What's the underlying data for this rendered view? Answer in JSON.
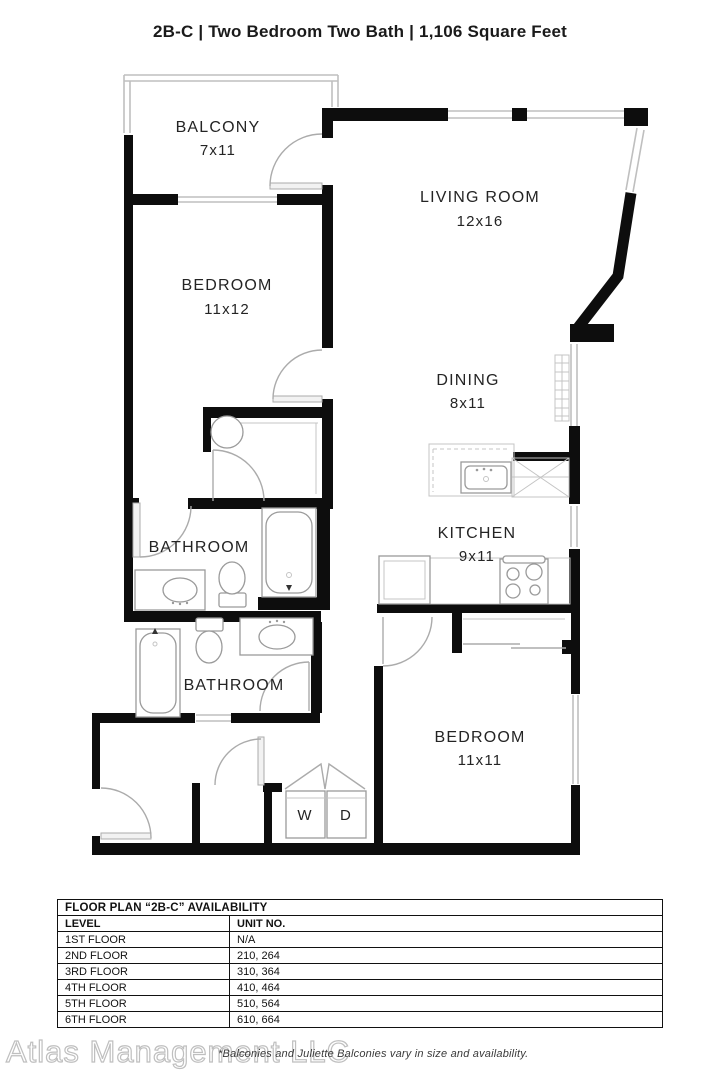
{
  "title": "2B-C | Two Bedroom Two Bath | 1,106 Square Feet",
  "floor_plan": {
    "balcony": {
      "label": "BALCONY",
      "dims": "7x11"
    },
    "living": {
      "label": "LIVING ROOM",
      "dims": "12x16"
    },
    "bedroom1": {
      "label": "BEDROOM",
      "dims": "11x12"
    },
    "dining": {
      "label": "DINING",
      "dims": "8x11"
    },
    "kitchen": {
      "label": "KITCHEN",
      "dims": "9x11"
    },
    "bathroom1": {
      "label": "BATHROOM"
    },
    "bathroom2": {
      "label": "BATHROOM"
    },
    "bedroom2": {
      "label": "BEDROOM",
      "dims": "11x11"
    },
    "washer_label": "W",
    "dryer_label": "D"
  },
  "availability_table": {
    "title": "FLOOR PLAN “2B-C” AVAILABILITY",
    "columns": [
      "LEVEL",
      "UNIT NO."
    ],
    "rows": [
      [
        "1ST FLOOR",
        "N/A"
      ],
      [
        "2ND FLOOR",
        "210, 264"
      ],
      [
        "3RD FLOOR",
        "310, 364"
      ],
      [
        "4TH FLOOR",
        "410, 464"
      ],
      [
        "5TH FLOOR",
        "510, 564"
      ],
      [
        "6TH FLOOR",
        "610, 664"
      ]
    ]
  },
  "footer": {
    "watermark": "Atlas Management LLC",
    "disclaimer": "*Balconies and Juliette Balconies vary in size and availability."
  },
  "colors": {
    "wall": "#0d0d0d",
    "window": "#bfbfbf",
    "fixture": "#9a9a9a",
    "text": "#242424"
  }
}
